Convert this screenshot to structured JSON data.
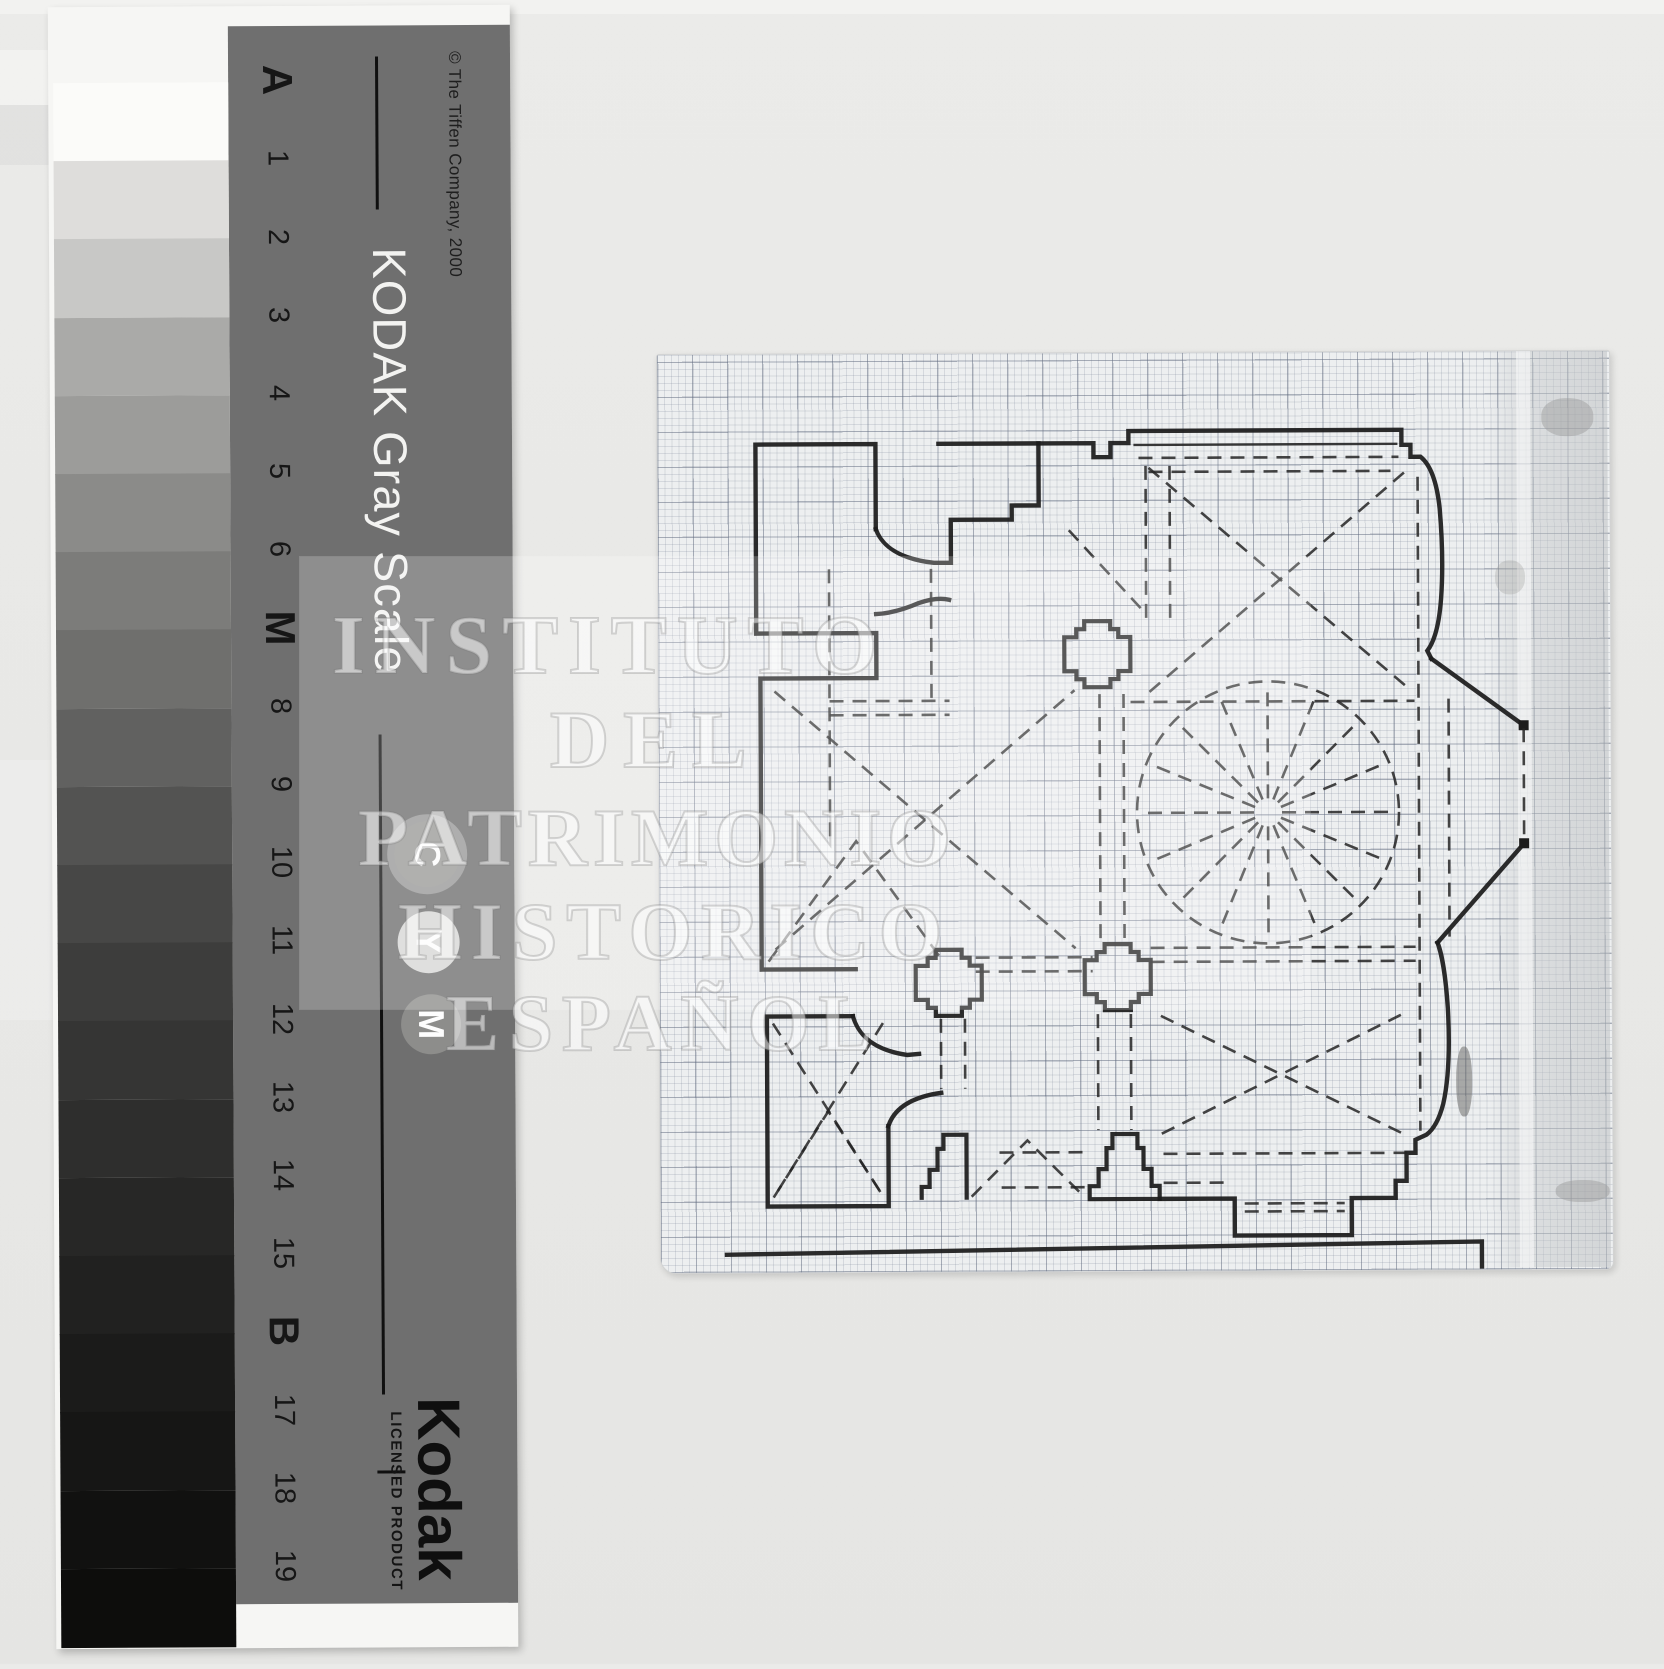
{
  "scan": {
    "background_color": "#e8e8e6",
    "paper_color": "#edeff0",
    "ink_color": "#1c1c1c"
  },
  "watermark": {
    "lines": [
      "INSTITUTO",
      "DEL",
      "PATRIMONIO",
      "HISTORICO",
      "ESPAÑOL"
    ]
  },
  "gray_scale_card": {
    "copyright": "© The Tiffen Company, 2000",
    "title": "KODAK Gray Scale",
    "logo": "Kodak",
    "logo_subtitle": "LICENSED PRODUCT",
    "band_color": "#6f6f6f",
    "patch_labels": [
      "A",
      "1",
      "2",
      "3",
      "4",
      "5",
      "6",
      "M",
      "8",
      "9",
      "10",
      "11",
      "12",
      "13",
      "14",
      "15",
      "B",
      "17",
      "18",
      "19"
    ],
    "patch_colors": [
      "#fbfbf9",
      "#dedddb",
      "#c8c8c6",
      "#aaaaa8",
      "#9c9c9a",
      "#8b8b89",
      "#7c7c7a",
      "#6f6f6d",
      "#616160",
      "#535352",
      "#474746",
      "#3d3d3c",
      "#353534",
      "#2e2e2d",
      "#272726",
      "#212120",
      "#1b1b1a",
      "#161615",
      "#111110",
      "#0d0d0c"
    ],
    "color_circles": [
      {
        "label": "C",
        "bg": "#9a9a98"
      },
      {
        "label": "Y",
        "bg": "#d7d7d5"
      },
      {
        "label": "M",
        "bg": "#8d8d8b"
      }
    ]
  },
  "drawing": {
    "description": "Church floor plan with domed crossing drawn in ink on millimeter graph paper"
  }
}
